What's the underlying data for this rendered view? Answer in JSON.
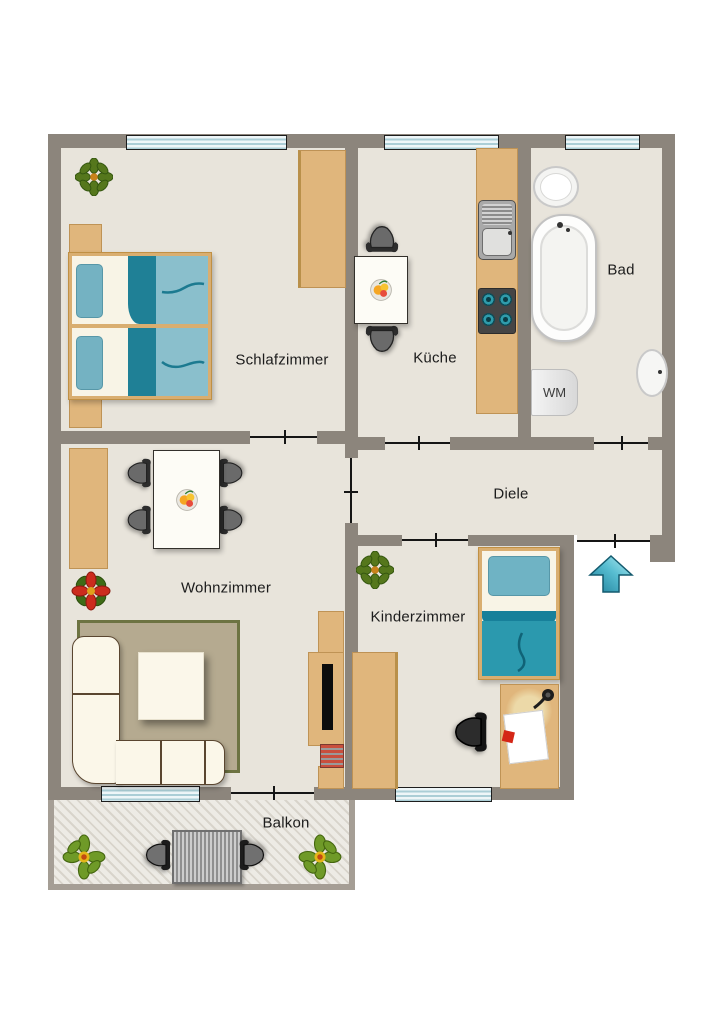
{
  "rooms": {
    "schlafzimmer": {
      "label": "Schlafzimmer"
    },
    "kueche": {
      "label": "Küche"
    },
    "bad": {
      "label": "Bad"
    },
    "diele": {
      "label": "Diele"
    },
    "wohnzimmer": {
      "label": "Wohnzimmer"
    },
    "kinderzimmer": {
      "label": "Kinderzimmer"
    },
    "balkon": {
      "label": "Balkon"
    }
  },
  "appliances": {
    "washing_machine": "WM"
  },
  "entry": {
    "direction": "up"
  },
  "colors": {
    "wall": "#8c857c",
    "floor": "#e8e4db",
    "tan": "#e0b67c",
    "teal_dark": "#1f8096",
    "teal_light": "#8abfcc",
    "window": "#d9ecf1",
    "balcony_wall": "#a59e95",
    "rug": "#b5aa90",
    "rug_border": "#6d7342",
    "arrow": "#3fa9c0"
  }
}
